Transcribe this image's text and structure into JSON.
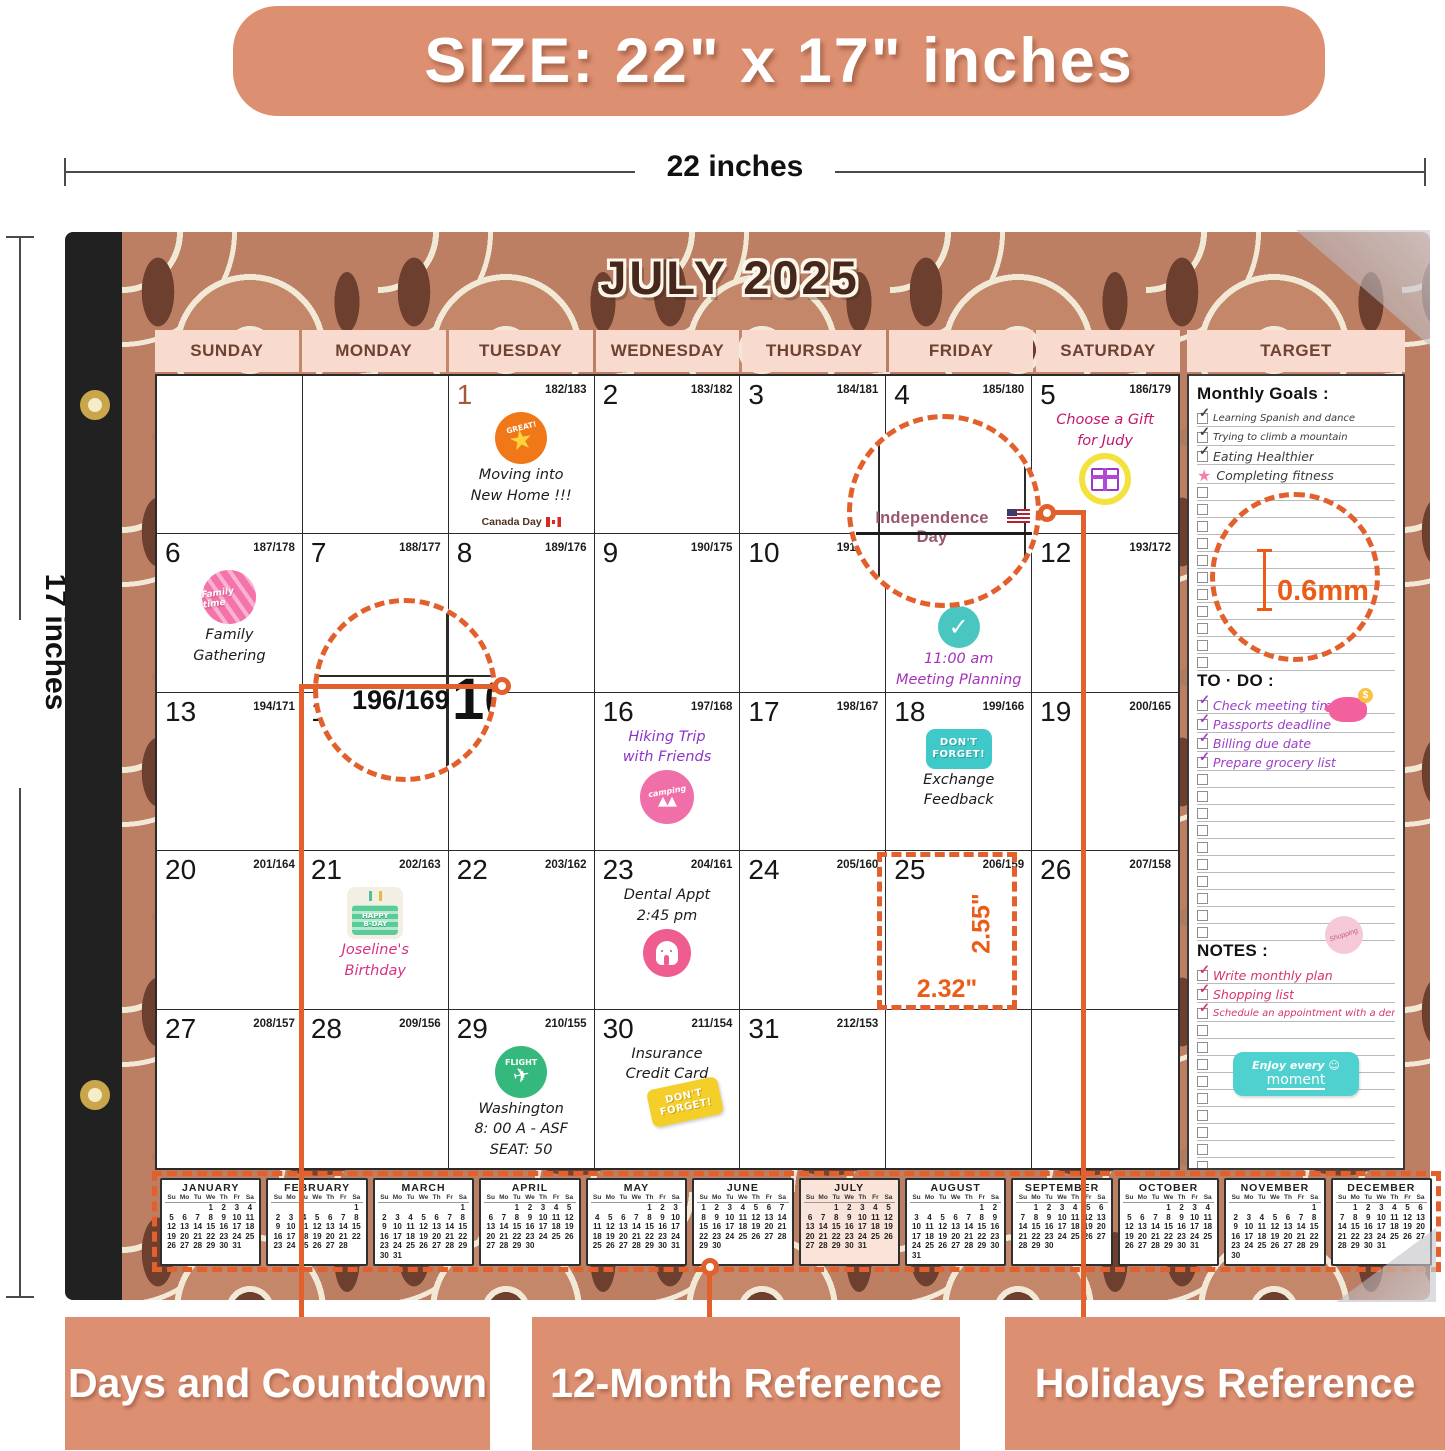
{
  "banner": {
    "text": "SIZE: 22\" x 17\" inches"
  },
  "dimensions": {
    "width": "22 inches",
    "height": "17 inches"
  },
  "calendar": {
    "title": "JULY 2025",
    "weekdays": [
      "SUNDAY",
      "MONDAY",
      "TUESDAY",
      "WEDNESDAY",
      "THURSDAY",
      "FRIDAY",
      "SATURDAY"
    ],
    "target_title": "TARGET",
    "cells": [
      {
        "day": "",
        "cd": ""
      },
      {
        "day": "",
        "cd": ""
      },
      {
        "day": "1",
        "cd": "182/183",
        "day_color": "#a3593a",
        "sticker": "great",
        "lines": [
          {
            "t": "Moving into",
            "c": "#1c1c1c"
          },
          {
            "t": "New Home !!!",
            "c": "#1c1c1c"
          }
        ],
        "holiday": {
          "t": "Canada Day",
          "flag": "canada"
        }
      },
      {
        "day": "2",
        "cd": "183/182"
      },
      {
        "day": "3",
        "cd": "184/181"
      },
      {
        "day": "4",
        "cd": "185/180"
      },
      {
        "day": "5",
        "cd": "186/179",
        "text_first": true,
        "sticker": "gift",
        "lines": [
          {
            "t": "Choose a Gift",
            "c": "#c2186b"
          },
          {
            "t": "for Judy",
            "c": "#c2186b"
          }
        ]
      },
      {
        "day": "6",
        "cd": "187/178",
        "sticker": "family",
        "lines": [
          {
            "t": "Family",
            "c": "#1c1c1c"
          },
          {
            "t": "Gathering",
            "c": "#1c1c1c"
          }
        ]
      },
      {
        "day": "7",
        "cd": "188/177"
      },
      {
        "day": "8",
        "cd": "189/176"
      },
      {
        "day": "9",
        "cd": "190/175"
      },
      {
        "day": "10",
        "cd": "191/174"
      },
      {
        "day": "",
        "cd": "",
        "sticker": "check",
        "lines": [
          {
            "t": "11:00 am",
            "c": "#a433b8"
          },
          {
            "t": "Meeting Planning",
            "c": "#a433b8"
          }
        ]
      },
      {
        "day": "12",
        "cd": "193/172"
      },
      {
        "day": "13",
        "cd": "194/171"
      },
      {
        "day": "14",
        "cd": ""
      },
      {
        "day": "",
        "cd": ""
      },
      {
        "day": "16",
        "cd": "197/168",
        "text_first": true,
        "sticker": "camping",
        "lines": [
          {
            "t": "Hiking Trip",
            "c": "#8d35c8"
          },
          {
            "t": "with Friends",
            "c": "#8d35c8"
          }
        ]
      },
      {
        "day": "17",
        "cd": "198/167"
      },
      {
        "day": "18",
        "cd": "199/166",
        "sticker": "dont_forget_teal",
        "lines": [
          {
            "t": "Exchange",
            "c": "#1c1c1c"
          },
          {
            "t": "Feedback",
            "c": "#1c1c1c"
          }
        ]
      },
      {
        "day": "19",
        "cd": "200/165"
      },
      {
        "day": "20",
        "cd": "201/164"
      },
      {
        "day": "21",
        "cd": "202/163",
        "sticker": "bday",
        "lines": [
          {
            "t": "Joseline's",
            "c": "#d63384"
          },
          {
            "t": "Birthday",
            "c": "#d63384"
          }
        ]
      },
      {
        "day": "22",
        "cd": "203/162"
      },
      {
        "day": "23",
        "cd": "204/161",
        "text_first": true,
        "sticker": "tooth",
        "lines": [
          {
            "t": "Dental Appt",
            "c": "#1c1c1c"
          },
          {
            "t": "2:45 pm",
            "c": "#1c1c1c"
          }
        ]
      },
      {
        "day": "24",
        "cd": "205/160"
      },
      {
        "day": "25",
        "cd": "206/159"
      },
      {
        "day": "26",
        "cd": "207/158"
      },
      {
        "day": "27",
        "cd": "208/157"
      },
      {
        "day": "28",
        "cd": "209/156"
      },
      {
        "day": "29",
        "cd": "210/155",
        "sticker": "flight",
        "lines": [
          {
            "t": "Washington",
            "c": "#1c1c1c"
          },
          {
            "t": "8: 00 A - ASF",
            "c": "#1c1c1c"
          },
          {
            "t": "SEAT: 50",
            "c": "#1c1c1c"
          }
        ]
      },
      {
        "day": "30",
        "cd": "211/154",
        "text_first": true,
        "sticker": "dont_forget_yellow",
        "lines": [
          {
            "t": "Insurance",
            "c": "#1c1c1c"
          },
          {
            "t": "Credit Card",
            "c": "#1c1c1c"
          }
        ]
      },
      {
        "day": "31",
        "cd": "212/153"
      },
      {
        "day": "",
        "cd": ""
      },
      {
        "day": "",
        "cd": ""
      }
    ]
  },
  "stickers": {
    "great": "GREAT!",
    "family": "Family time",
    "camping": "camping",
    "dont_forget": "DON'T FORGET!",
    "happy_bday": "HAPPY B-DAY",
    "flight": "FLIGHT",
    "shopping": "Shopping",
    "enjoy_line1": "Enjoy every",
    "enjoy_line2": "moment",
    "coin": "$"
  },
  "target": {
    "monthly_goals": {
      "heading": "Monthly Goals :",
      "empty_rows": 11,
      "items": [
        "Learning Spanish and dance",
        "Trying to climb a mountain",
        "Eating Healthier",
        "Completing fitness"
      ],
      "marks": [
        "check",
        "check",
        "check",
        "star"
      ]
    },
    "todo": {
      "heading": "TO · DO :",
      "empty_rows": 10,
      "items": [
        "Check meeting time",
        "Passports deadline",
        "Billing due date",
        "Prepare grocery list"
      ],
      "marks": [
        "check",
        "check",
        "check",
        "check"
      ]
    },
    "notes": {
      "heading": "NOTES :",
      "empty_rows": 11,
      "items": [
        "Write monthly plan",
        "Shopping list",
        "Schedule an appointment with a dentist"
      ],
      "marks": [
        "check",
        "check",
        "check"
      ]
    }
  },
  "annotations": {
    "holiday_magnifier": {
      "text": "Independence Day"
    },
    "countdown_magnifier": {
      "countdown": "196/169",
      "day": "16",
      "partial": "169"
    },
    "thickness": "0.6mm",
    "cell_height": "2.55\"",
    "cell_width": "2.32\"",
    "labels": [
      "Days and Countdown",
      "12-Month Reference",
      "Holidays Reference"
    ]
  },
  "mini": {
    "dow": [
      "Su",
      "Mo",
      "Tu",
      "We",
      "Th",
      "Fr",
      "Sa"
    ],
    "months": [
      {
        "name": "JANUARY",
        "first": 3,
        "days": 31
      },
      {
        "name": "FEBRUARY",
        "first": 6,
        "days": 28
      },
      {
        "name": "MARCH",
        "first": 6,
        "days": 31
      },
      {
        "name": "APRIL",
        "first": 2,
        "days": 30
      },
      {
        "name": "MAY",
        "first": 4,
        "days": 31
      },
      {
        "name": "JUNE",
        "first": 0,
        "days": 30
      },
      {
        "name": "JULY",
        "first": 2,
        "days": 31,
        "highlight": true
      },
      {
        "name": "AUGUST",
        "first": 5,
        "days": 31
      },
      {
        "name": "SEPTEMBER",
        "first": 1,
        "days": 30
      },
      {
        "name": "OCTOBER",
        "first": 3,
        "days": 31
      },
      {
        "name": "NOVEMBER",
        "first": 6,
        "days": 30
      },
      {
        "name": "DECEMBER",
        "first": 1,
        "days": 31
      }
    ]
  }
}
